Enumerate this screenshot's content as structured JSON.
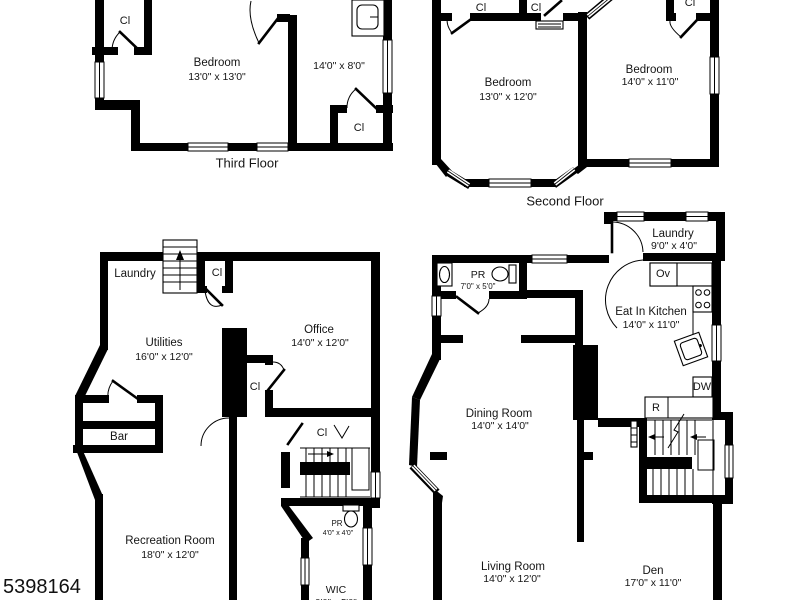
{
  "photo_id": "5398164",
  "colors": {
    "wall": "#000000",
    "background": "#ffffff"
  },
  "floors": {
    "third": {
      "title": "Third Floor",
      "closet_top": "Cl",
      "closet_bottom": "Cl",
      "bedroom": {
        "name": "Bedroom",
        "dims": "13'0\" x 13'0\""
      },
      "bonus_room": {
        "dims": "14'0\" x 8'0\""
      }
    },
    "second": {
      "title": "Second Floor",
      "closet_left_a": "Cl",
      "closet_left_b": "Cl",
      "closet_right": "Cl",
      "bedroom_left": {
        "name": "Bedroom",
        "dims": "13'0\" x 12'0\""
      },
      "bedroom_right": {
        "name": "Bedroom",
        "dims": "14'0\" x 11'0\""
      }
    },
    "lower": {
      "laundry": "Laundry",
      "closet_stairs": "Cl",
      "utilities": {
        "name": "Utilities",
        "dims": "16'0\" x 12'0\""
      },
      "office": {
        "name": "Office",
        "dims": "14'0\" x 12'0\""
      },
      "closet_mid": "Cl",
      "bar": "Bar",
      "recreation": {
        "name": "Recreation Room",
        "dims": "18'0\" x 12'0\""
      },
      "closet_br": "Cl",
      "powder": {
        "name": "PR",
        "dims": "4'0\" x 4'0\""
      },
      "wic": {
        "name": "WIC",
        "dims": "9'0\" x 5'0\""
      }
    },
    "first": {
      "laundry": {
        "name": "Laundry",
        "dims": "9'0\" x 4'0\""
      },
      "powder": {
        "name": "PR",
        "dims": "7'0\" x 5'0\""
      },
      "kitchen": {
        "name": "Eat In Kitchen",
        "dims": "14'0\" x 11'0\""
      },
      "oven": "Ov",
      "dishwasher": "DW",
      "refrigerator": "R",
      "dining": {
        "name": "Dining Room",
        "dims": "14'0\" x 14'0\""
      },
      "living": {
        "name": "Living Room",
        "dims": "14'0\" x 12'0\""
      },
      "den": {
        "name": "Den",
        "dims": "17'0\" x 11'0\""
      }
    }
  }
}
